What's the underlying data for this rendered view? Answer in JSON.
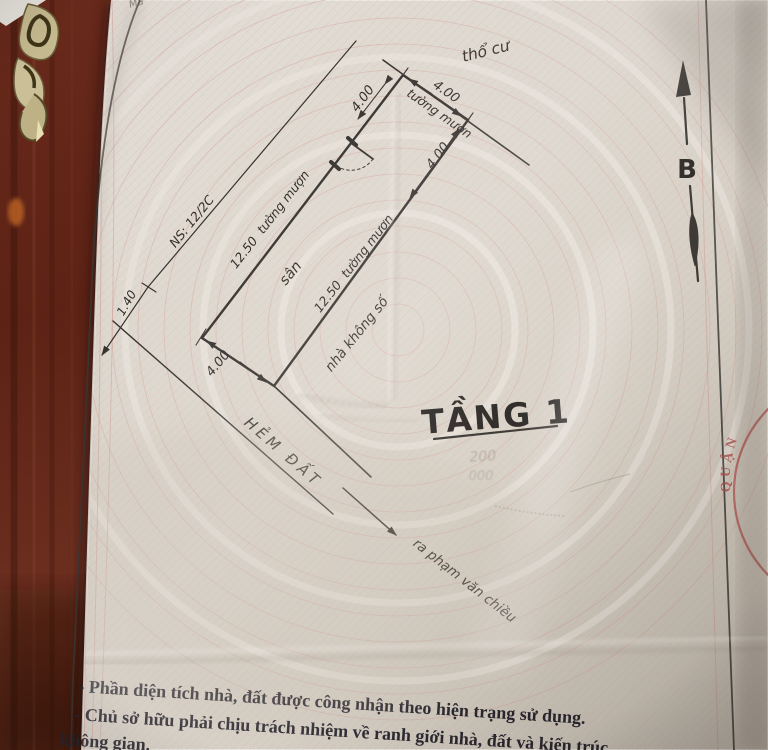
{
  "scene": {
    "description": "photo of a cadastral house/land sketch page lying on a dark wooden table",
    "colors": {
      "wood": "#5e2418",
      "paper": "#ddd7cd",
      "ink": "#2e2a26",
      "guilloche_pink": "#d9a79b",
      "stamp_red": "#b14f4b"
    }
  },
  "document": {
    "top_edge_fragment": "Mẫ",
    "plan": {
      "floor_title": "TẦNG 1",
      "north_label": "B",
      "land_type_label": "thổ cư",
      "alley_label": "HẺM ĐẤT",
      "alley_direction_label": "ra phạm văn chiều",
      "neighbor_house_number_label": "NS: 12/2C",
      "neighbor_no_number_label": "nhà không số",
      "yard_label": "sân",
      "stamp_arc_text": "QUẬN",
      "faint_mark_1": "200",
      "faint_mark_2": "000",
      "dims": {
        "front_width": "4.00",
        "front_wall_note": "tường mượn",
        "left_entry": "4.00",
        "right_entry": "4.00",
        "left_depth": "12.50",
        "left_wall_note": "tường mượn",
        "right_depth": "12.50",
        "right_wall_note": "tường mượn",
        "rear_width": "4.00",
        "alley_setback": "1.40"
      }
    },
    "notes": {
      "line1": "- Phần diện tích nhà, đất được công nhận theo hiện trạng sử dụng.",
      "line2": "- Chủ sở hữu phải chịu trách nhiệm về ranh giới nhà, đất và kiến trúc",
      "line3": "không gian."
    }
  }
}
